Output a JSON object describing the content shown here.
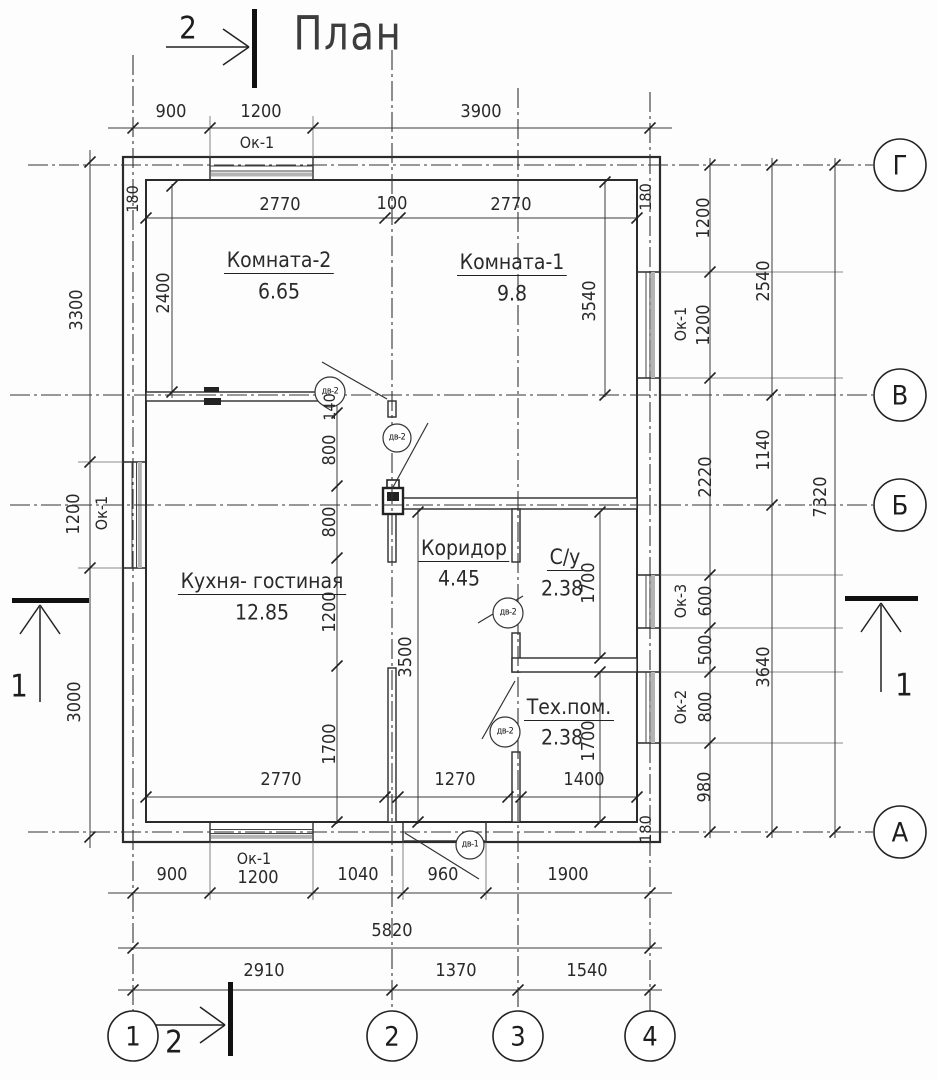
{
  "title": "План",
  "sections": {
    "top": "2",
    "bottom": "2",
    "left": "1",
    "right": "1"
  },
  "axes": {
    "c1": "1",
    "c2": "2",
    "c3": "3",
    "c4": "4",
    "rG": "Г",
    "rV": "В",
    "rB": "Б",
    "rA": "А"
  },
  "rooms": {
    "k2n": "Комната-2",
    "k2a": "6.65",
    "k1n": "Комната-1",
    "k1a": "9.8",
    "kgn": "Кухня- гостиная",
    "kga": "12.85",
    "korn": "Коридор",
    "kora": "4.45",
    "sun": "С/у",
    "sua": "2.38",
    "tehn": "Тех.пом.",
    "teha": "2.38"
  },
  "doors": {
    "dv2": "дв-2",
    "dv1": "дв-1"
  },
  "dims": {
    "t900": "900",
    "t1200": "1200",
    "t3900": "3900",
    "tok": "Ок-1",
    "b900": "900",
    "bok": "Ок-1",
    "b1200": "1200",
    "b1040": "1040",
    "b960": "960",
    "b1900": "1900",
    "b5820": "5820",
    "b2910": "2910",
    "b1370": "1370",
    "b1540": "1540",
    "l3300": "3300",
    "l1200": "1200",
    "lok": "Ок-1",
    "l3000": "3000",
    "l180": "180",
    "l2400": "2400",
    "it2770a": "2770",
    "it100": "100",
    "it2770b": "2770",
    "ir180": "180",
    "m140": "140",
    "m800a": "800",
    "m800b": "800",
    "m1200": "1200",
    "m1700": "1700",
    "m3500": "3500",
    "r3540": "3540",
    "rsu1700": "1700",
    "rteh1700": "1700",
    "ib2770": "2770",
    "ib1270": "1270",
    "ib1400": "1400",
    "ibr180": "180",
    "ri1200a": "1200",
    "riok1": "Ок-1",
    "ri1200b": "1200",
    "ri2220": "2220",
    "ri600": "600",
    "riok3": "Ок-3",
    "ri500": "500",
    "ri800": "800",
    "riok2": "Ок-2",
    "ri980": "980",
    "ro2540": "2540",
    "ro1140": "1140",
    "ro3640": "3640",
    "ro7320": "7320"
  }
}
